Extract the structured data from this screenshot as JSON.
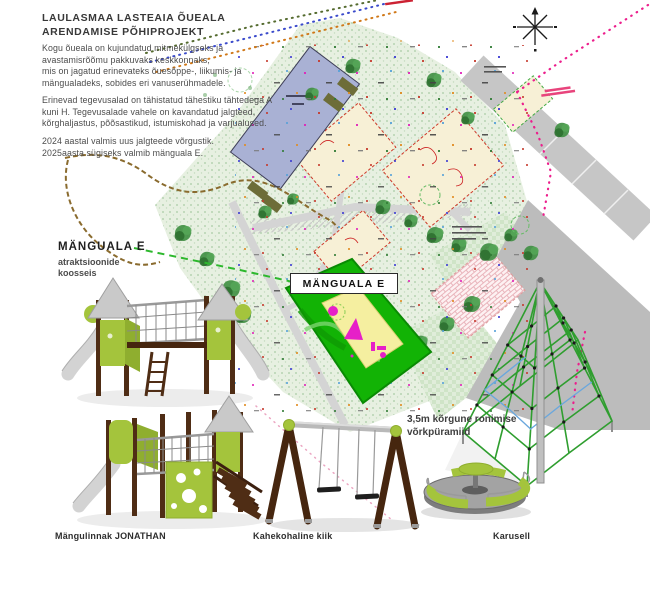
{
  "header": {
    "title": "LAULASMAA LASTEAIA ÕUEALA\nARENDAMISE PÕHIPROJEKT",
    "intro": "Kogu õueala on kujundatud mitmekülgseks ja\navastamisrõõmu pakkuvaks keskkonnaks,\nmis on jagatud erinevateks õuesõppe-, liikumis- ja\nmängualadeks, sobides eri vanuserühmadele.",
    "zones": "Erinevad tegevusalad on tähistatud tähestiku tähtedega A\nkuni H. Tegevusalade vahele on kavandatud jalgteed,\nkõrghaljastus, põõsastikud, istumiskohad ja varjualused.",
    "timeline": "2024 aastal valmis uus jalgteede võrgustik.\n2025aasta sügiseks valmib mänguala E."
  },
  "playground_section": {
    "heading": "MÄNGUALA E",
    "subheading": "atraktsioonide\nkoosseis"
  },
  "site_plan": {
    "zone_label": "MÄNGUALA E",
    "north_arrow_icon": "north-arrow",
    "colors": {
      "zone_green": "#12b305",
      "zone_inner_yellow": "#f5efa0",
      "zone_marker_magenta": "#e620c8",
      "building_blue": "#a9b1d4",
      "road_gray": "#c6c6c6",
      "vegetation_green": "#e7f0e1",
      "boundary_magenta": "#ec1e8c"
    }
  },
  "equipment": {
    "tower_caption": "Mängulinnak JONATHAN",
    "swing_caption": "Kahekohaline kiik",
    "carousel_caption": "Karusell",
    "pyramid_note": "3,5m kõrgune ronimise\nvõrkpüramiid",
    "colors": {
      "wood_brown": "#4f2d15",
      "panel_green": "#a4c43c",
      "metal_gray": "#c9c9c9"
    }
  }
}
